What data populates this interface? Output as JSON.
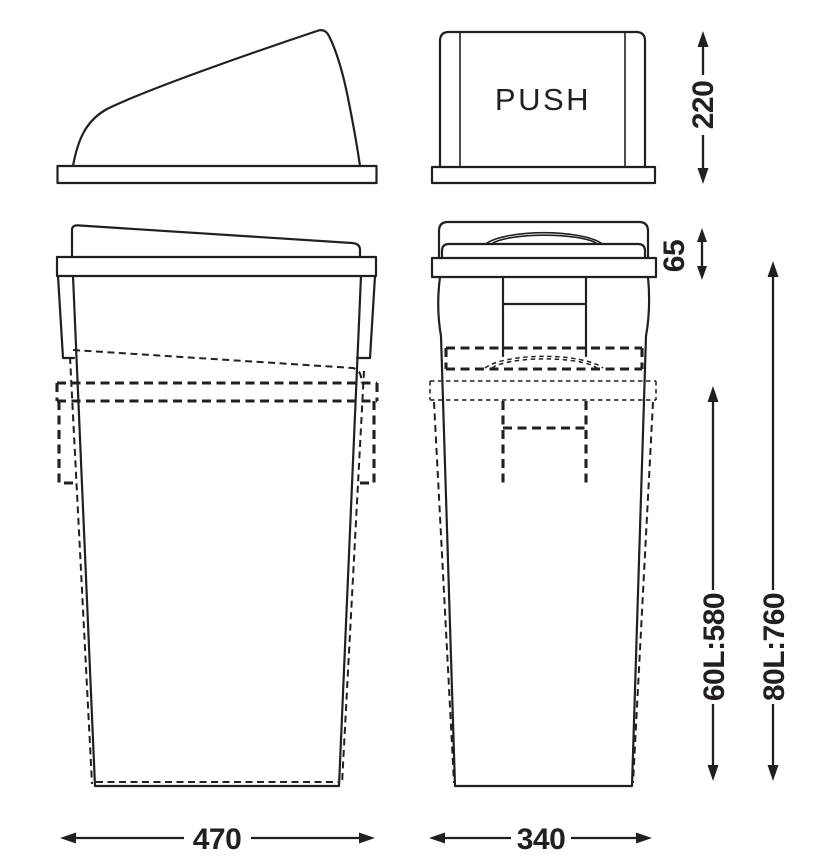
{
  "lid_front_view": {
    "push_label": "PUSH"
  },
  "dimensions": {
    "lid_height": "220",
    "lid_rim_height": "65",
    "bin_depth": "470",
    "bin_width": "340",
    "height_60l": "60L:580",
    "height_80l": "80L:760"
  },
  "colors": {
    "line": "#231f20",
    "background": "#ffffff"
  }
}
